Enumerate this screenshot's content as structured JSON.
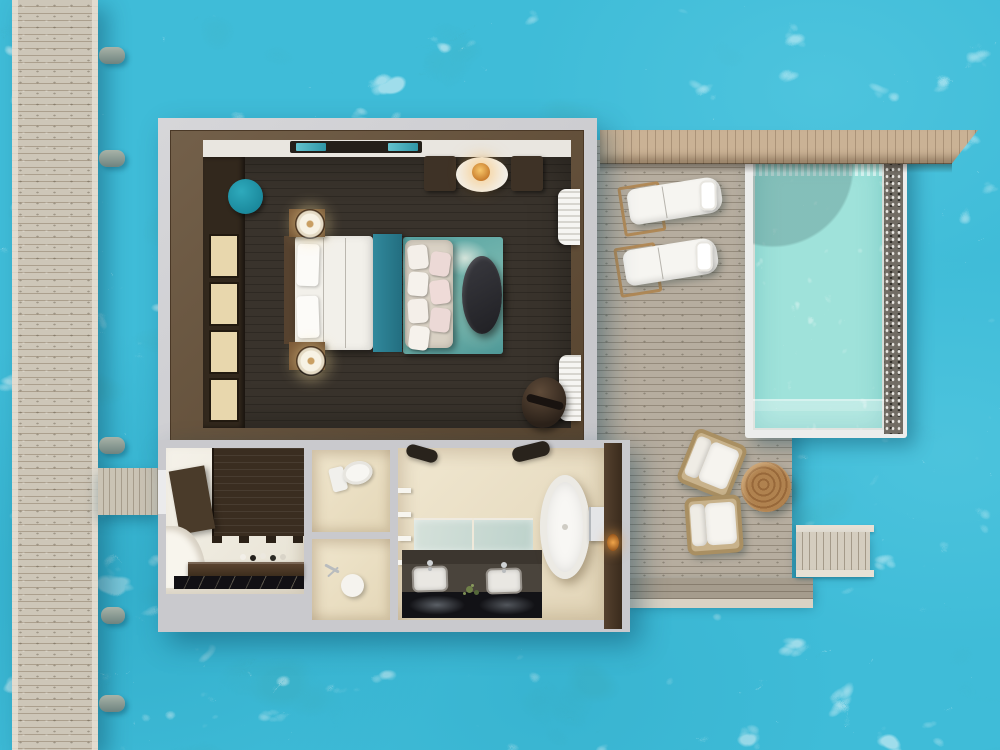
{
  "scene": {
    "description": "Top-down 3D rendered floor plan of an overwater villa: wooden jetty over turquoise sea, bedroom with king bed and lounge chairs, three-part bathroom with freestanding tub and double vanity, sun deck with loungers and armchairs, private infinity pool and sea steps",
    "view": "top-down plan render",
    "visible_text": []
  },
  "palette": {
    "sea_water": "#3fbcd8",
    "sea_caustics": "#c6eef6",
    "pool_water": "#9fe2da",
    "jetty_plank": "#cdc6b8",
    "deck_plank": "#b6ad9f",
    "roof_plank": "#cab295",
    "villa_outer_wall_gray": "#cdced1",
    "villa_wood_frame": "#6a5640",
    "bedroom_floor_dark": "#39332c",
    "bathroom_floor_cream": "#ece1c8",
    "linen_white": "#f4f2ec",
    "teal_accent": "#2a7f92",
    "teal_pouf": "#1f93a8",
    "rug_teal": "#57a3a2",
    "wardrobe_panel_cream": "#e8d7ad",
    "vanity_charcoal": "#4a443c",
    "marble_black": "#121014",
    "wood_table": "#a87c4b",
    "pebble_border": "#716c64",
    "pendant_amber": "#e8a13c"
  },
  "structures": {
    "jetty": {
      "name": "wooden-jetty",
      "orientation": "vertical",
      "pole_count": 5
    },
    "walkway": {
      "name": "entry-walkway",
      "connects": "jetty to villa"
    },
    "roof_overhang": {
      "name": "roof-overhang",
      "orientation": "horizontal strip over pool edge"
    },
    "sea_steps": {
      "name": "sea-access-steps",
      "location": "lower right of deck"
    }
  },
  "bedroom": {
    "furniture": [
      {
        "name": "tv-console",
        "color": "#241f19"
      },
      {
        "name": "wardrobe",
        "doors": 4,
        "door_color": "#e8d7ad"
      },
      {
        "name": "teal-pouf",
        "shape": "round"
      },
      {
        "name": "double-bed",
        "linen": "white",
        "runner": "teal"
      },
      {
        "name": "nightstand-with-lamp",
        "count": 2
      },
      {
        "name": "foot-bench-daybed",
        "pillows": 7
      },
      {
        "name": "area-rug",
        "pattern": "teal abstract"
      },
      {
        "name": "coffee-table-oval",
        "color": "dark charcoal"
      },
      {
        "name": "lounge-armchair",
        "count": 2
      },
      {
        "name": "round-side-table-with-pendant-lamp",
        "count": 1
      },
      {
        "name": "hanging-round-chair",
        "count": 1
      },
      {
        "name": "curtain",
        "count": 2
      }
    ]
  },
  "bathroom": {
    "sections": [
      {
        "name": "dressing-area",
        "features": [
          "dark slat wardrobe",
          "amenity counter",
          "black marble runner",
          "corner steps"
        ]
      },
      {
        "name": "wc-compartment",
        "features": [
          "toilet"
        ]
      },
      {
        "name": "shower-compartment",
        "features": [
          "shower stool",
          "hand sprayer"
        ]
      },
      {
        "name": "main-bathroom",
        "features": [
          "ceiling fan",
          "wall shelves",
          "double mirror",
          "double-sink vanity",
          "freestanding bathtub",
          "tub fixture",
          "wall lamp"
        ]
      }
    ],
    "sink_count": 2
  },
  "deck": {
    "sun_loungers": 2,
    "lounger_towels": 2,
    "patio_armchairs": 2,
    "round_wood_table": 1,
    "lower_step_band": true
  },
  "pool": {
    "name": "private-infinity-pool",
    "frame_color": "#ecedec",
    "water_color": "#9fe2da",
    "pebble_edge": "right side",
    "entry_steps": "bottom",
    "umbrella_shadow": "top-left"
  }
}
